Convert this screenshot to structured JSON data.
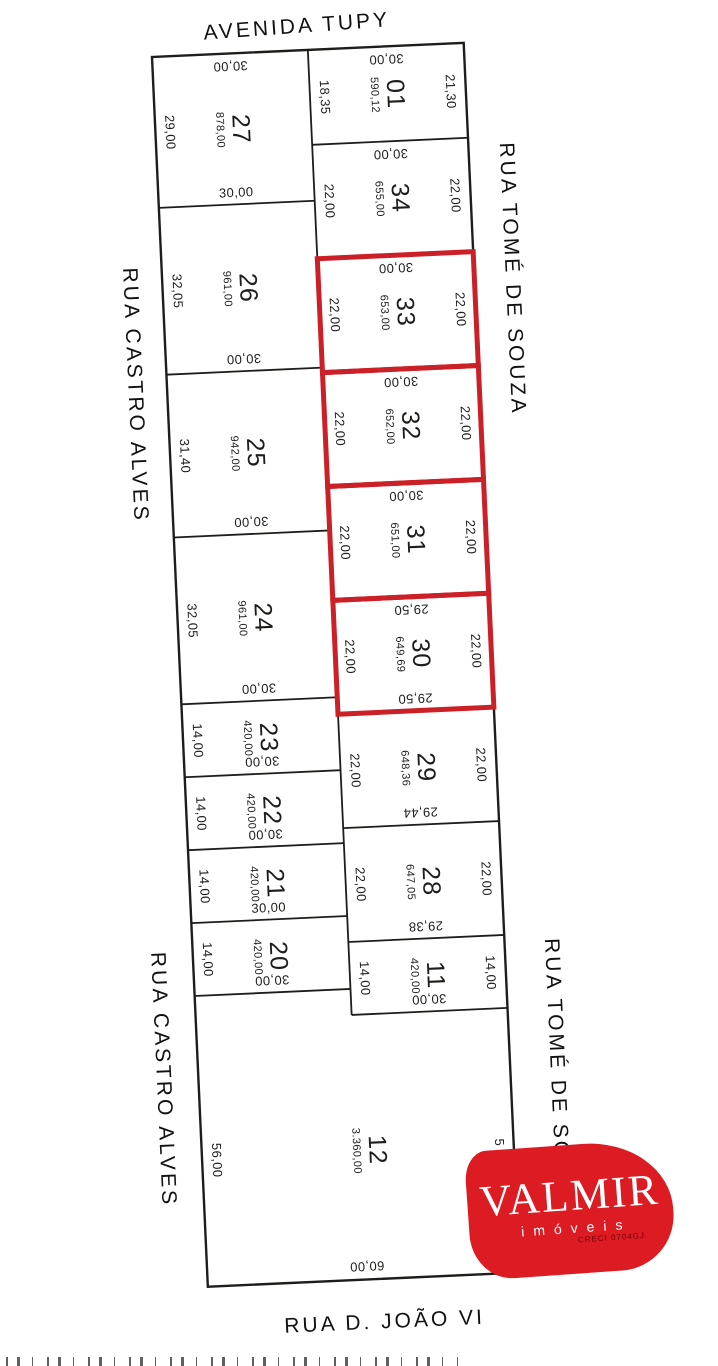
{
  "colors": {
    "line": "#1d1d1b",
    "highlight": "#cb2027",
    "logo_red": "#dd1b22",
    "background": "#ffffff"
  },
  "streets": {
    "top": "AVENIDA TUPY",
    "right_upper": "RUA TOMÉ DE SOUZA",
    "right_lower": "RUA TOMÉ DE SOUZA",
    "left_upper": "RUA CASTRO ALVES",
    "left_lower": "RUA CASTRO ALVES",
    "bottom": "RUA D. JOÃO VI"
  },
  "logo": {
    "name": "VALMIR",
    "subtitle": "imóveis",
    "creci": "CRECI 0704GJ"
  },
  "plan": {
    "px_per_m": 5.2,
    "column_width_m": 30,
    "left_lots": [
      {
        "number": "27",
        "area": "878,00",
        "depth_m": 29.0,
        "labels": {
          "top": {
            "text": "30,00",
            "rot": 180
          },
          "left": {
            "text": "29,00",
            "rot": 90
          },
          "bottom": {
            "text": "30,00",
            "rot": 0
          }
        }
      },
      {
        "number": "26",
        "area": "961,00",
        "depth_m": 32.05,
        "labels": {
          "left": {
            "text": "32,05",
            "rot": 90
          },
          "bottom": {
            "text": "30,00",
            "rot": 180
          }
        }
      },
      {
        "number": "25",
        "area": "942,00",
        "depth_m": 31.4,
        "labels": {
          "left": {
            "text": "31,40",
            "rot": 90
          },
          "bottom": {
            "text": "30,00",
            "rot": 180
          }
        }
      },
      {
        "number": "24",
        "area": "961,00",
        "depth_m": 32.05,
        "labels": {
          "left": {
            "text": "32,05",
            "rot": 90
          },
          "bottom": {
            "text": "30,00",
            "rot": 180
          }
        }
      },
      {
        "number": "23",
        "area": "420,00",
        "depth_m": 14.0,
        "labels": {
          "left": {
            "text": "14,00",
            "rot": 90
          },
          "bottom": {
            "text": "30,00",
            "rot": 180
          }
        }
      },
      {
        "number": "22",
        "area": "420,00",
        "depth_m": 14.0,
        "labels": {
          "left": {
            "text": "14,00",
            "rot": 90
          },
          "bottom": {
            "text": "30,00",
            "rot": 180
          }
        }
      },
      {
        "number": "21",
        "area": "420,00",
        "depth_m": 14.0,
        "labels": {
          "left": {
            "text": "14,00",
            "rot": 90
          },
          "bottom": {
            "text": "30,00",
            "rot": 0
          }
        }
      },
      {
        "number": "20",
        "area": "420,00",
        "depth_m": 14.0,
        "labels": {
          "left": {
            "text": "14,00",
            "rot": 90
          },
          "bottom": {
            "text": "30,00",
            "rot": 180
          }
        }
      }
    ],
    "right_lots": [
      {
        "number": "01",
        "area": "590,12",
        "depth_m": 18.35,
        "labels": {
          "top": {
            "text": "30,00",
            "rot": 180
          },
          "left": {
            "text": "18,35",
            "rot": 90
          },
          "right": {
            "text": "21,30",
            "rot": 90
          }
        }
      },
      {
        "number": "34",
        "area": "655,00",
        "depth_m": 22.0,
        "labels": {
          "top": {
            "text": "30,00",
            "rot": 180
          },
          "left": {
            "text": "22,00",
            "rot": 90
          },
          "right": {
            "text": "22,00",
            "rot": 90
          }
        }
      },
      {
        "number": "33",
        "area": "653,00",
        "depth_m": 22.0,
        "highlighted": true,
        "labels": {
          "top": {
            "text": "30,00",
            "rot": 180
          },
          "left": {
            "text": "22,00",
            "rot": 90
          },
          "right": {
            "text": "22,00",
            "rot": 90
          }
        }
      },
      {
        "number": "32",
        "area": "652,00",
        "depth_m": 22.0,
        "highlighted": true,
        "labels": {
          "top": {
            "text": "30,00",
            "rot": 180
          },
          "left": {
            "text": "22,00",
            "rot": 90
          },
          "right": {
            "text": "22,00",
            "rot": 90
          }
        }
      },
      {
        "number": "31",
        "area": "651,00",
        "depth_m": 22.0,
        "highlighted": true,
        "labels": {
          "top": {
            "text": "30,00",
            "rot": 180
          },
          "left": {
            "text": "22,00",
            "rot": 90
          },
          "right": {
            "text": "22,00",
            "rot": 90
          }
        }
      },
      {
        "number": "30",
        "area": "649,69",
        "depth_m": 22.0,
        "highlighted": true,
        "labels": {
          "top": {
            "text": "29,50",
            "rot": 180
          },
          "left": {
            "text": "22,00",
            "rot": 90
          },
          "right": {
            "text": "22,00",
            "rot": 90
          },
          "bottom": {
            "text": "29,50",
            "rot": 180
          }
        }
      },
      {
        "number": "29",
        "area": "648,36",
        "depth_m": 22.0,
        "labels": {
          "left": {
            "text": "22,00",
            "rot": 90
          },
          "right": {
            "text": "22,00",
            "rot": 90
          },
          "bottom": {
            "text": "29,44",
            "rot": 180
          }
        }
      },
      {
        "number": "28",
        "area": "647,05",
        "depth_m": 22.0,
        "labels": {
          "left": {
            "text": "22,00",
            "rot": 90
          },
          "right": {
            "text": "22,00",
            "rot": 90
          },
          "bottom": {
            "text": "29,38",
            "rot": 180
          }
        }
      },
      {
        "number": "11",
        "area": "420,00",
        "depth_m": 14.0,
        "labels": {
          "left": {
            "text": "14,00",
            "rot": 90
          },
          "right": {
            "text": "14,00",
            "rot": 90
          },
          "bottom": {
            "text": "30,00",
            "rot": 180
          }
        }
      }
    ],
    "bottom_lot": {
      "number": "12",
      "area": "3.360,00",
      "depth_m": 56.0,
      "labels": {
        "left": {
          "text": "56,00",
          "rot": 90
        },
        "bottom": {
          "text": "60,00",
          "rot": 180
        },
        "right": {
          "text": "5",
          "rot": 90
        }
      }
    }
  }
}
